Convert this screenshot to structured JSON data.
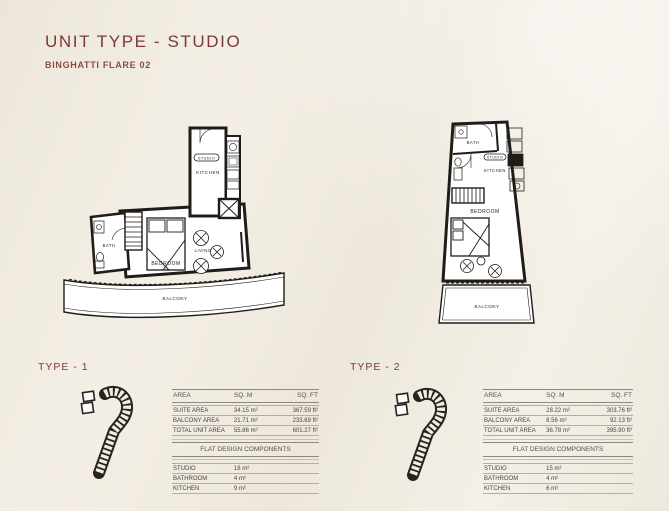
{
  "page": {
    "title": "UNIT TYPE - STUDIO",
    "subtitle": "BINGHATTI FLARE 02"
  },
  "colors": {
    "accent": "#7b3b34",
    "background": "#f1ece2",
    "plan_line": "#211c18"
  },
  "units": [
    {
      "type_label": "TYPE - 1",
      "rooms": {
        "kitchen": "KITCHEN",
        "studio_tag": "STUDIO",
        "bath": "BATH",
        "bedroom": "BEDROOM",
        "living": "LIVING",
        "balcony": "BALCONY"
      },
      "area_table": {
        "headers": [
          "AREA",
          "SQ. M",
          "SQ. FT"
        ],
        "rows": [
          {
            "label": "SUITE AREA",
            "sqm": "34.15 m²",
            "sqft": "367.59 ft²"
          },
          {
            "label": "BALCONY AREA",
            "sqm": "21.71 m²",
            "sqft": "233.69 ft²"
          },
          {
            "label": "TOTAL UNIT AREA",
            "sqm": "55.86 m²",
            "sqft": "601.27 ft²"
          }
        ]
      },
      "components_table": {
        "title": "FLAT DESIGN COMPONENTS",
        "rows": [
          {
            "label": "STUDIO",
            "value": "18 m²"
          },
          {
            "label": "BATHROOM",
            "value": "4 m²"
          },
          {
            "label": "KITCHEN",
            "value": "9 m²"
          }
        ]
      }
    },
    {
      "type_label": "TYPE - 2",
      "rooms": {
        "kitchen": "KITCHEN",
        "studio_tag": "STUDIO",
        "bath": "BATH",
        "bedroom": "BEDROOM",
        "balcony": "BALCONY"
      },
      "area_table": {
        "headers": [
          "AREA",
          "SQ. M",
          "SQ. FT"
        ],
        "rows": [
          {
            "label": "SUITE AREA",
            "sqm": "28.22 m²",
            "sqft": "303.76 ft²"
          },
          {
            "label": "BALCONY AREA",
            "sqm": "8.56 m²",
            "sqft": "92.13 ft²"
          },
          {
            "label": "TOTAL UNIT AREA",
            "sqm": "36.78 m²",
            "sqft": "395.90 ft²"
          }
        ]
      },
      "components_table": {
        "title": "FLAT DESIGN COMPONENTS",
        "rows": [
          {
            "label": "STUDIO",
            "value": "15 m²"
          },
          {
            "label": "BATHROOM",
            "value": "4 m²"
          },
          {
            "label": "KITCHEN",
            "value": "6 m²"
          }
        ]
      }
    }
  ]
}
